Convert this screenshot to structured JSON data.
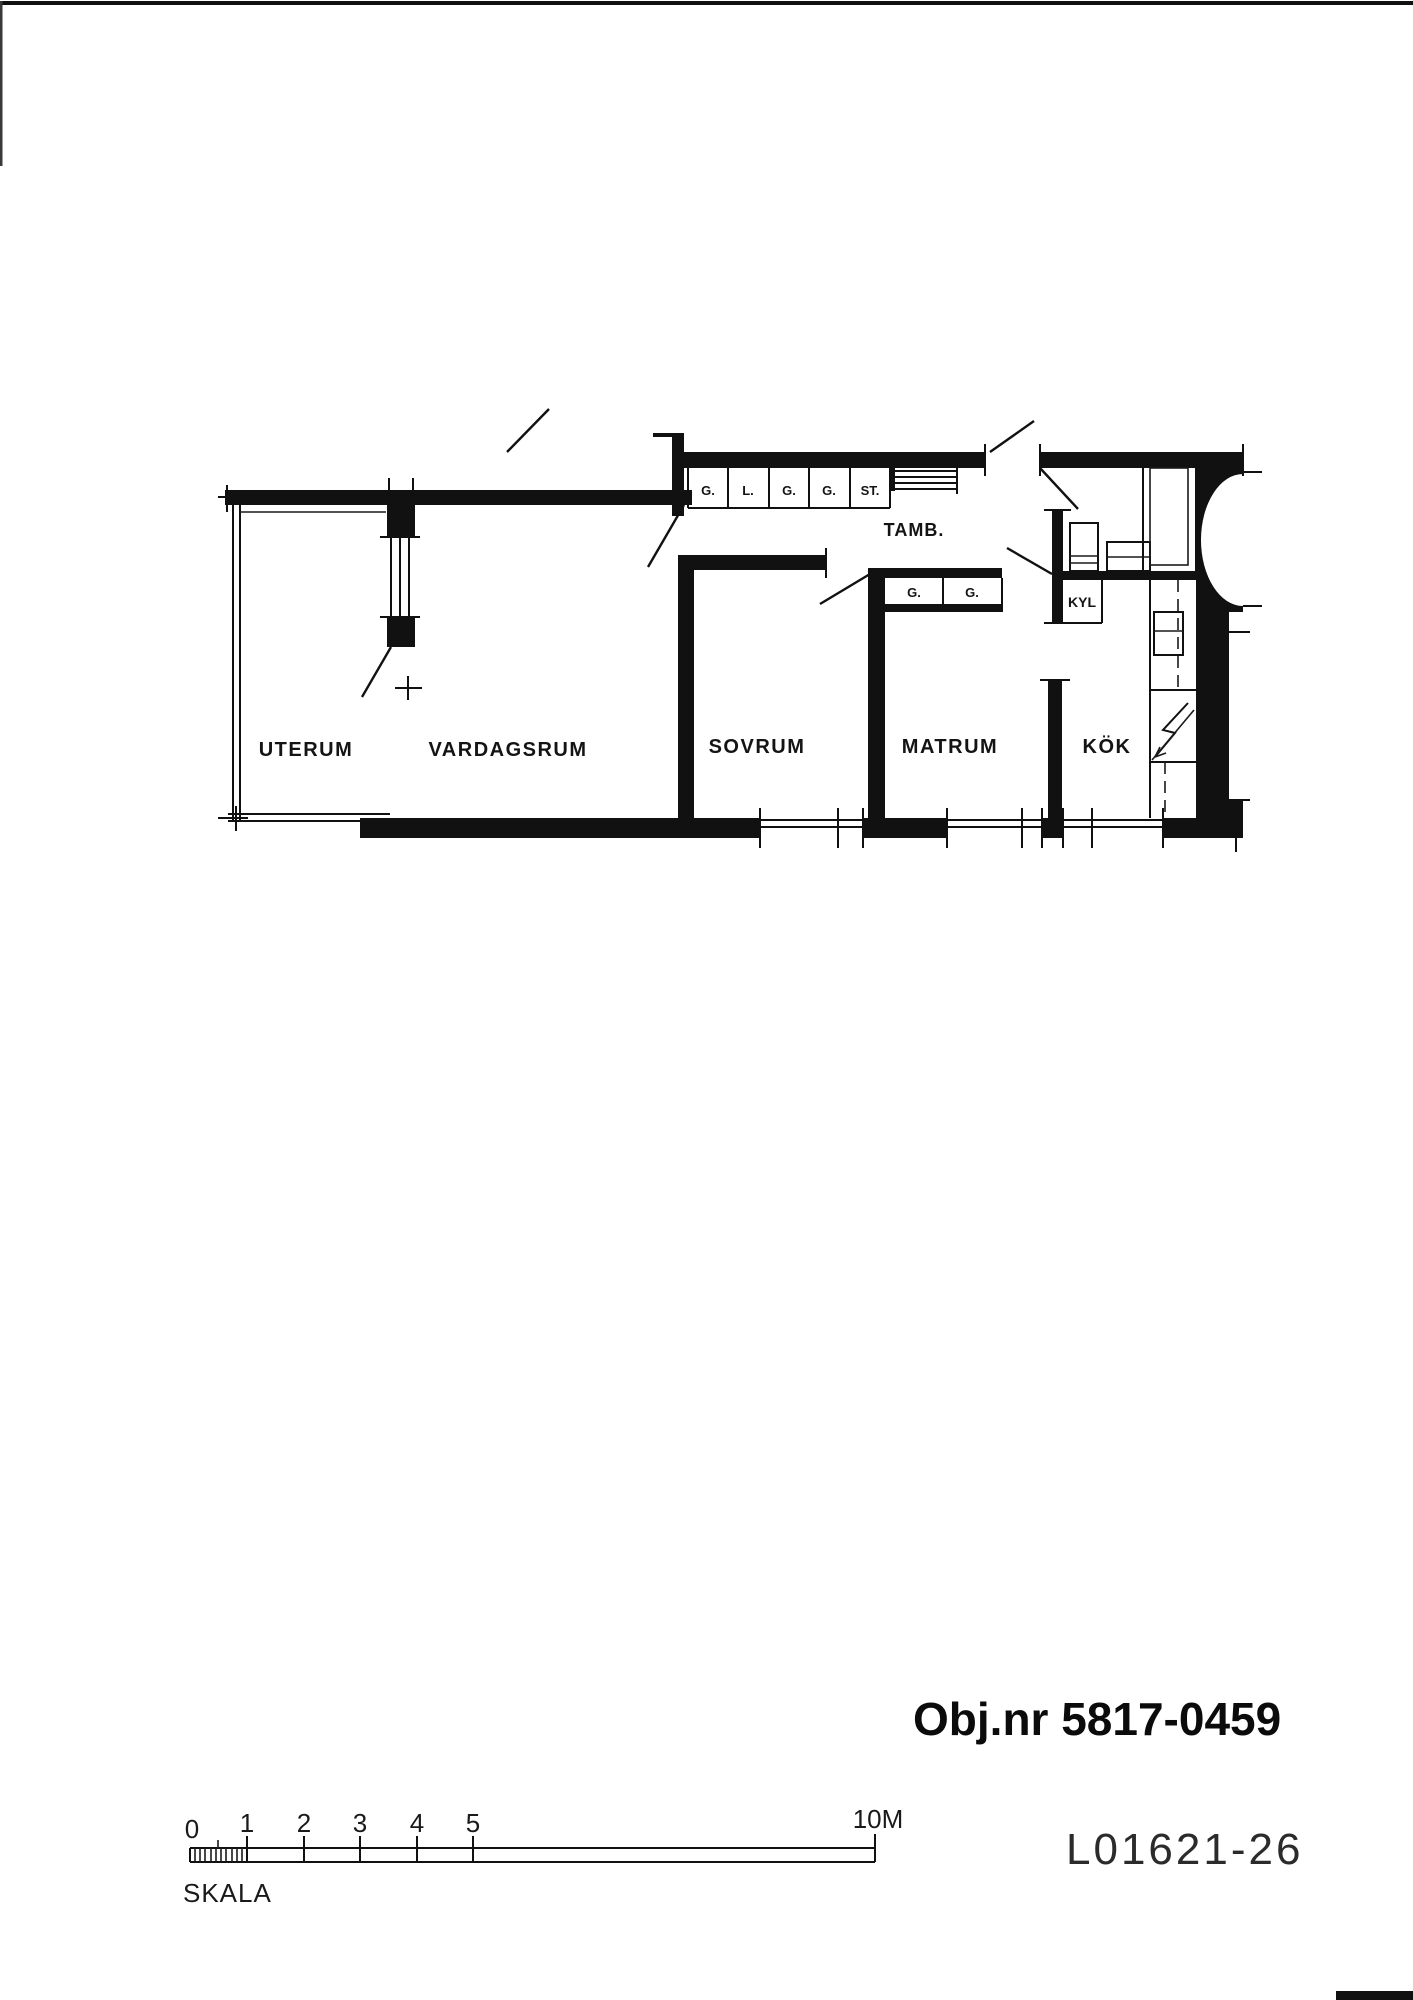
{
  "drawing": {
    "object_number_label": "Obj.nr 5817-0459",
    "sheet_number": "L01621-26",
    "scale": {
      "label": "SKALA",
      "ticks": [
        "0",
        "1",
        "2",
        "3",
        "4",
        "5"
      ],
      "max_label": "10M"
    },
    "rooms": {
      "uterum": "UTERUM",
      "vardagsrum": "VARDAGSRUM",
      "sovrum": "SOVRUM",
      "matrum": "MATRUM",
      "kok": "KÖK",
      "tambur": "TAMB."
    },
    "closets_hall_top": [
      "G.",
      "L.",
      "G.",
      "G.",
      "ST."
    ],
    "closets_matrum": [
      "G.",
      "G."
    ],
    "appliances": {
      "fridge": "KYL"
    },
    "colors": {
      "ink": "#111111",
      "paper": "#ffffff"
    }
  }
}
